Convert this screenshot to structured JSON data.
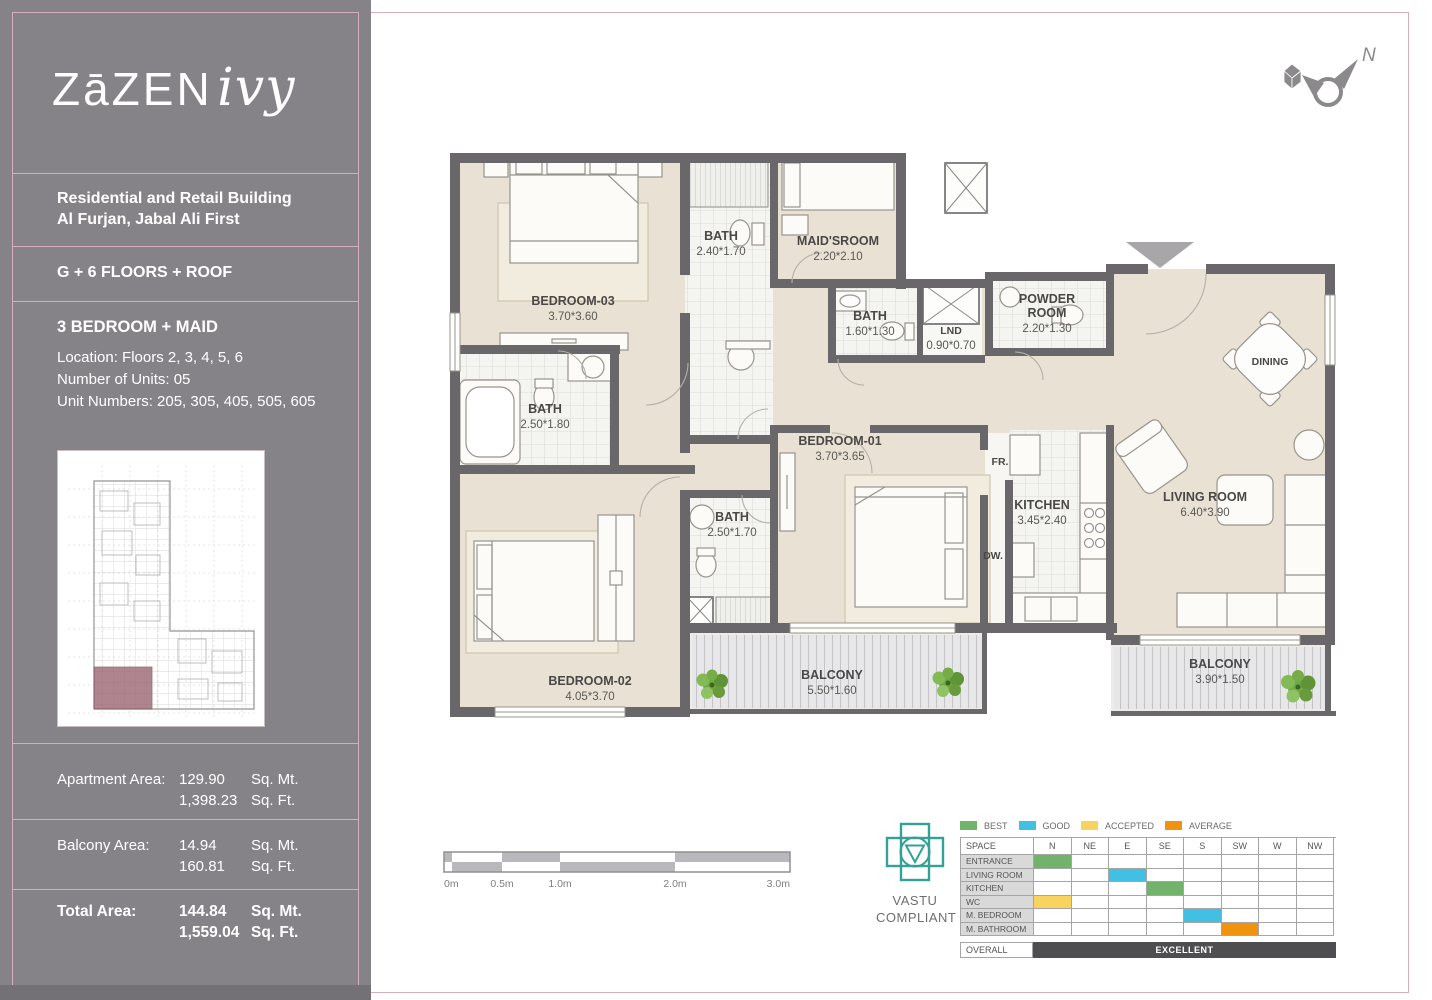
{
  "page": {
    "accent": "#d6afbc",
    "sidebar_bg": "#858388"
  },
  "sidebar": {
    "logo_main": "ZāZEN",
    "logo_script": "ivy",
    "building_line1": "Residential and Retail Building",
    "building_line2": "Al Furjan, Jabal Ali First",
    "floors_line": "G + 6 FLOORS + ROOF",
    "unit_type": "3 BEDROOM + MAID",
    "location_line": "Location: Floors 2, 3, 4, 5, 6",
    "units_line": "Number of Units: 05",
    "unit_numbers_line": "Unit Numbers: 205, 305, 405, 505, 605",
    "areas": [
      {
        "label": "Apartment Area:",
        "mt": "129.90",
        "mt_unit": "Sq. Mt.",
        "ft": "1,398.23",
        "ft_unit": "Sq. Ft."
      },
      {
        "label": "Balcony Area:",
        "mt": "14.94",
        "mt_unit": "Sq. Mt.",
        "ft": "160.81",
        "ft_unit": "Sq. Ft."
      },
      {
        "label": "Total Area:",
        "mt": "144.84",
        "mt_unit": "Sq. Mt.",
        "ft": "1,559.04",
        "ft_unit": "Sq. Ft."
      }
    ]
  },
  "plan": {
    "compass_label": "N",
    "rooms": [
      {
        "name": "BEDROOM-03",
        "dims": "3.70*3.60",
        "x": 133,
        "y": 160
      },
      {
        "name": "BATH",
        "dims": "2.40*1.70",
        "x": 281,
        "y": 95
      },
      {
        "name": "MAID'SROOM",
        "dims": "2.20*2.10",
        "x": 398,
        "y": 100
      },
      {
        "name": "BATH",
        "dims": "1.60*1.30",
        "x": 430,
        "y": 175
      },
      {
        "name": "LND",
        "dims": "0.90*0.70",
        "x": 511,
        "y": 189,
        "small": true
      },
      {
        "name": "POWDER\nROOM",
        "dims": "2.20*1.30",
        "x": 607,
        "y": 158
      },
      {
        "name": "BATH",
        "dims": "2.50*1.80",
        "x": 105,
        "y": 268
      },
      {
        "name": "BATH",
        "dims": "2.50*1.70",
        "x": 292,
        "y": 376
      },
      {
        "name": "BEDROOM-01",
        "dims": "3.70*3.65",
        "x": 400,
        "y": 300
      },
      {
        "name": "KITCHEN",
        "dims": "3.45*2.40",
        "x": 602,
        "y": 364
      },
      {
        "name": "LIVING ROOM",
        "dims": "6.40*3.90",
        "x": 765,
        "y": 356
      },
      {
        "name": "DINING",
        "dims": "",
        "x": 830,
        "y": 220,
        "small": true
      },
      {
        "name": "BEDROOM-02",
        "dims": "4.05*3.70",
        "x": 150,
        "y": 540
      },
      {
        "name": "BALCONY",
        "dims": "5.50*1.60",
        "x": 392,
        "y": 534
      },
      {
        "name": "BALCONY",
        "dims": "3.90*1.50",
        "x": 780,
        "y": 523
      },
      {
        "name": "FR.",
        "dims": "",
        "x": 560,
        "y": 320,
        "small": true
      },
      {
        "name": "DW.",
        "dims": "",
        "x": 553,
        "y": 414,
        "small": true
      }
    ]
  },
  "scalebar": {
    "labels": [
      "0m",
      "0.5m",
      "1.0m",
      "2.0m",
      "3.0m"
    ]
  },
  "vastu": {
    "caption_line1": "VASTU",
    "caption_line2": "COMPLIANT",
    "legend": [
      {
        "label": "BEST",
        "color": "#71b36a"
      },
      {
        "label": "GOOD",
        "color": "#41c0e3"
      },
      {
        "label": "ACCEPTED",
        "color": "#f8d35e"
      },
      {
        "label": "AVERAGE",
        "color": "#f0930f"
      }
    ],
    "space_header": "SPACE",
    "directions": [
      "N",
      "NE",
      "E",
      "SE",
      "S",
      "SW",
      "W",
      "NW"
    ],
    "rows": [
      {
        "space": "ENTRANCE",
        "direction": "N",
        "rating": "BEST"
      },
      {
        "space": "LIVING ROOM",
        "direction": "E",
        "rating": "GOOD"
      },
      {
        "space": "KITCHEN",
        "direction": "SE",
        "rating": "BEST"
      },
      {
        "space": "WC",
        "direction": "N",
        "rating": "ACCEPTED"
      },
      {
        "space": "M. BEDROOM",
        "direction": "S",
        "rating": "GOOD"
      },
      {
        "space": "M. BATHROOM",
        "direction": "SW",
        "rating": "AVERAGE"
      }
    ],
    "overall_label": "OVERALL",
    "overall_value": "EXCELLENT"
  }
}
